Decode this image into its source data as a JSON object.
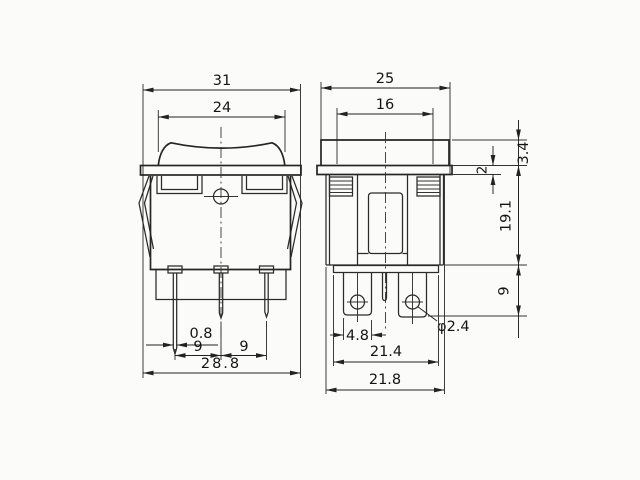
{
  "drawing_type": "rocker-switch-dimension-drawing",
  "dimensions": {
    "front_view": {
      "flange_width": "31",
      "rocker_width": "24",
      "terminal_thickness": "0.8",
      "terminal_pitch_left": "9",
      "terminal_pitch_right": "9",
      "overall_width": "28.8"
    },
    "side_view": {
      "flange_length": "25",
      "inner_length": "16",
      "bezel_height": "3.4",
      "panel_gap": "2",
      "body_depth": "19.1",
      "terminal_length": "9",
      "terminal_width": "4.8",
      "hole_diameter": "φ2.4",
      "base_length": "21.4",
      "overall_length": "21.8"
    }
  }
}
